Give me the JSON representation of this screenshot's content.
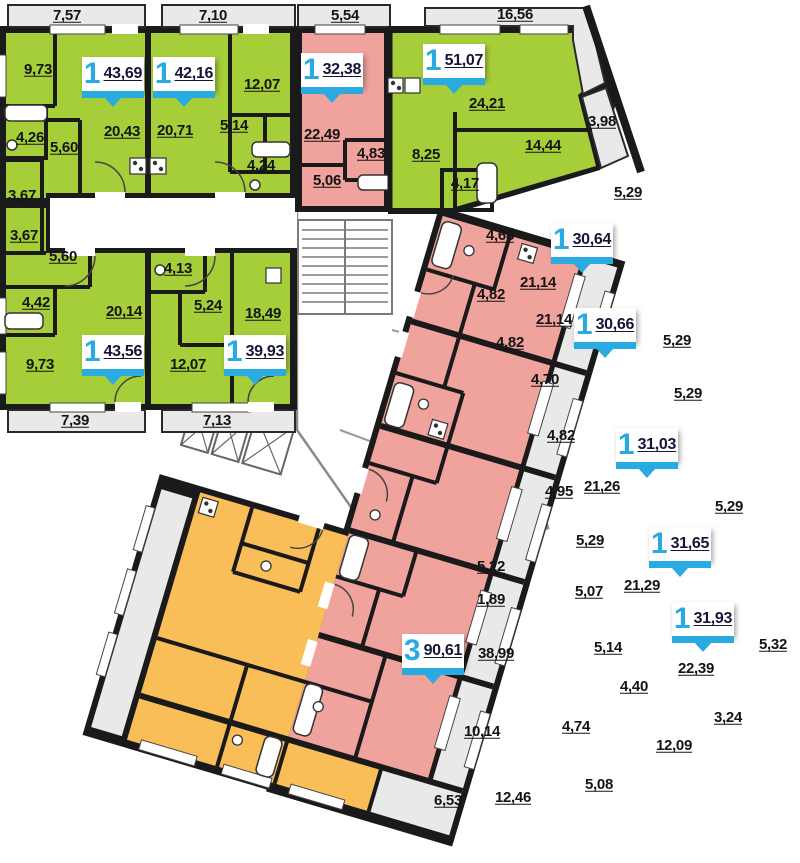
{
  "title": "Residential floor plan",
  "colors": {
    "green": "#A6CE39",
    "pink": "#F0A29D",
    "orange": "#F9BE58",
    "balcony_gray": "#E9E9E9",
    "wall": "#1A1A1A",
    "badge_blue": "#29ABE2",
    "label_text": "#141414"
  },
  "apartment_badges": [
    {
      "rooms": "1",
      "area": "43,69",
      "x": 82,
      "y": 57
    },
    {
      "rooms": "1",
      "area": "42,16",
      "x": 153,
      "y": 57
    },
    {
      "rooms": "1",
      "area": "32,38",
      "x": 301,
      "y": 53
    },
    {
      "rooms": "1",
      "area": "51,07",
      "x": 423,
      "y": 44
    },
    {
      "rooms": "1",
      "area": "30,64",
      "x": 551,
      "y": 223
    },
    {
      "rooms": "1",
      "area": "30,66",
      "x": 574,
      "y": 308
    },
    {
      "rooms": "1",
      "area": "31,03",
      "x": 616,
      "y": 428
    },
    {
      "rooms": "1",
      "area": "31,65",
      "x": 649,
      "y": 527
    },
    {
      "rooms": "1",
      "area": "31,93",
      "x": 672,
      "y": 602
    },
    {
      "rooms": "3",
      "area": "90,61",
      "x": 402,
      "y": 634
    },
    {
      "rooms": "1",
      "area": "43,56",
      "x": 82,
      "y": 335
    },
    {
      "rooms": "1",
      "area": "39,93",
      "x": 224,
      "y": 335
    }
  ],
  "dimension_labels": [
    {
      "t": "7,57",
      "x": 67,
      "y": 16
    },
    {
      "t": "7,10",
      "x": 213,
      "y": 16
    },
    {
      "t": "5,54",
      "x": 345,
      "y": 16
    },
    {
      "t": "16,56",
      "x": 515,
      "y": 15
    },
    {
      "t": "9,73",
      "x": 38,
      "y": 70
    },
    {
      "t": "12,07",
      "x": 262,
      "y": 85
    },
    {
      "t": "20,43",
      "x": 122,
      "y": 132
    },
    {
      "t": "20,71",
      "x": 175,
      "y": 131
    },
    {
      "t": "5,14",
      "x": 234,
      "y": 126
    },
    {
      "t": "4,26",
      "x": 30,
      "y": 138
    },
    {
      "t": "5,60",
      "x": 64,
      "y": 148
    },
    {
      "t": "4,24",
      "x": 261,
      "y": 166
    },
    {
      "t": "3,67",
      "x": 22,
      "y": 196
    },
    {
      "t": "3,67",
      "x": 24,
      "y": 236
    },
    {
      "t": "5,60",
      "x": 63,
      "y": 257
    },
    {
      "t": "4,42",
      "x": 36,
      "y": 303
    },
    {
      "t": "4,13",
      "x": 178,
      "y": 269
    },
    {
      "t": "20,14",
      "x": 124,
      "y": 312
    },
    {
      "t": "5,24",
      "x": 208,
      "y": 306
    },
    {
      "t": "18,49",
      "x": 263,
      "y": 314
    },
    {
      "t": "9,73",
      "x": 40,
      "y": 365
    },
    {
      "t": "12,07",
      "x": 188,
      "y": 365
    },
    {
      "t": "7,39",
      "x": 75,
      "y": 421
    },
    {
      "t": "7,13",
      "x": 217,
      "y": 421
    },
    {
      "t": "22,49",
      "x": 322,
      "y": 135
    },
    {
      "t": "4,83",
      "x": 371,
      "y": 154
    },
    {
      "t": "5,06",
      "x": 327,
      "y": 181
    },
    {
      "t": "8,25",
      "x": 426,
      "y": 155
    },
    {
      "t": "24,21",
      "x": 487,
      "y": 104
    },
    {
      "t": "14,44",
      "x": 543,
      "y": 146
    },
    {
      "t": "4,17",
      "x": 465,
      "y": 184
    },
    {
      "t": "3,98",
      "x": 602,
      "y": 122
    },
    {
      "t": "5,29",
      "x": 628,
      "y": 193
    },
    {
      "t": "4,68",
      "x": 500,
      "y": 236
    },
    {
      "t": "21,14",
      "x": 538,
      "y": 283
    },
    {
      "t": "4,82",
      "x": 491,
      "y": 295
    },
    {
      "t": "21,14",
      "x": 554,
      "y": 320
    },
    {
      "t": "5,29",
      "x": 677,
      "y": 341
    },
    {
      "t": "4,82",
      "x": 510,
      "y": 343
    },
    {
      "t": "4,70",
      "x": 545,
      "y": 380
    },
    {
      "t": "5,29",
      "x": 688,
      "y": 394
    },
    {
      "t": "4,82",
      "x": 561,
      "y": 436
    },
    {
      "t": "21,26",
      "x": 602,
      "y": 487
    },
    {
      "t": "4,95",
      "x": 559,
      "y": 492
    },
    {
      "t": "5,29",
      "x": 729,
      "y": 507
    },
    {
      "t": "5,29",
      "x": 590,
      "y": 541
    },
    {
      "t": "21,29",
      "x": 642,
      "y": 586
    },
    {
      "t": "5,07",
      "x": 589,
      "y": 592
    },
    {
      "t": "5,32",
      "x": 773,
      "y": 645
    },
    {
      "t": "5,14",
      "x": 608,
      "y": 648
    },
    {
      "t": "22,39",
      "x": 696,
      "y": 669
    },
    {
      "t": "4,40",
      "x": 634,
      "y": 687
    },
    {
      "t": "3,24",
      "x": 728,
      "y": 718
    },
    {
      "t": "5,22",
      "x": 491,
      "y": 567
    },
    {
      "t": "1,89",
      "x": 491,
      "y": 600
    },
    {
      "t": "38,99",
      "x": 496,
      "y": 654
    },
    {
      "t": "10,14",
      "x": 482,
      "y": 732
    },
    {
      "t": "4,74",
      "x": 576,
      "y": 727
    },
    {
      "t": "12,09",
      "x": 674,
      "y": 746
    },
    {
      "t": "12,46",
      "x": 513,
      "y": 798
    },
    {
      "t": "5,08",
      "x": 599,
      "y": 785
    },
    {
      "t": "6,53",
      "x": 448,
      "y": 801
    }
  ]
}
